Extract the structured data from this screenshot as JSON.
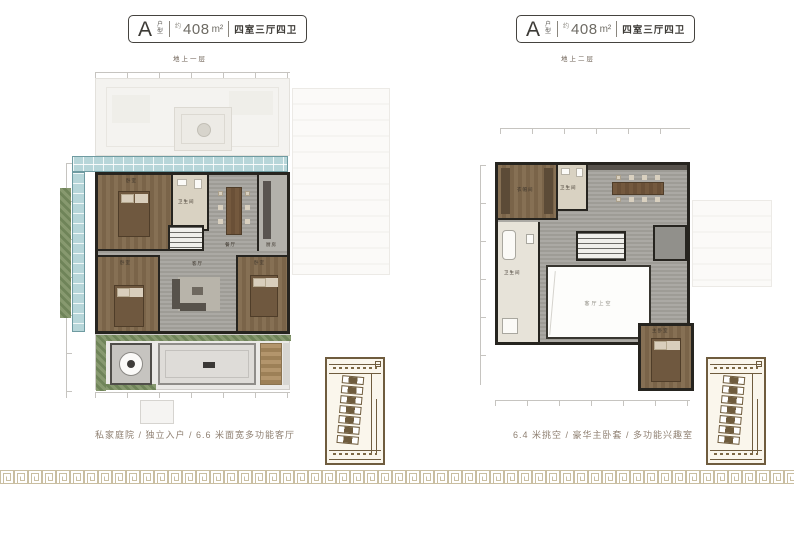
{
  "panels": [
    {
      "header": {
        "letter": "A",
        "letter_suffix": "户型",
        "approx_prefix": "约",
        "area_value": "408",
        "area_unit": "m²",
        "spec": "四室三厅四卫"
      },
      "floor_label": "地上一层",
      "caption": "私家庭院 / 独立入户 / 6.6 米面宽多功能客厅",
      "rooms": {
        "bedroom_a": "卧室",
        "bath_a": "卫生间",
        "dining": "餐厅",
        "kitchen": "厨房",
        "bedroom_b": "卧室",
        "living": "客厅",
        "bedroom_c": "卧室"
      }
    },
    {
      "header": {
        "letter": "A",
        "letter_suffix": "户型",
        "approx_prefix": "约",
        "area_value": "408",
        "area_unit": "m²",
        "spec": "四室三厅四卫"
      },
      "floor_label": "地上二层",
      "caption": "6.4 米挑空 / 豪华主卧套 / 多功能兴趣室",
      "rooms": {
        "cloakroom": "衣帽间",
        "bath_a": "卫生间",
        "bath_b": "卫生间",
        "void_label": "客厅上空",
        "master": "主卧室"
      }
    }
  ],
  "colors": {
    "wall": "#26241f",
    "floor_gray": "#a6a49e",
    "wood": "#7c6549",
    "tile_beige": "#d9d2c2",
    "glass_sunroom": "#b7d6d9",
    "greenery": "#7f9368",
    "keymap_sepia": "#6f5c3e",
    "meander_border": "#c9bea1",
    "caption_text": "#8f8072",
    "badge_border": "#45433f"
  }
}
